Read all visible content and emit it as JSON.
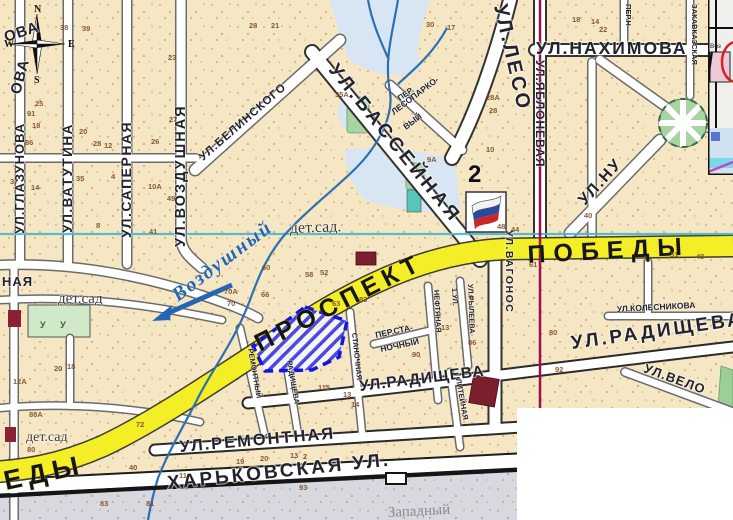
{
  "page": {
    "title": "Городская карта — Проспект Победы"
  },
  "colors": {
    "map_bg": "#f6e7c4",
    "road_yellow": "#f3ee25",
    "river_blue": "#2e6fb4",
    "grid_cyan": "#45b8cc",
    "route_red": "#99114d",
    "selection_blue": "#1515e0",
    "park_green": "#a8d4a4",
    "flag_blue": "#2b4a9e",
    "flag_red": "#cc2525",
    "label_dark": "#23232e",
    "number_brown": "#7c4a26"
  },
  "compass": {
    "n": "N",
    "w": "W",
    "e": "E",
    "s": "S"
  },
  "zone_number": "2",
  "inset": {
    "label": "Воз"
  },
  "labels": {
    "streets": [
      {
        "id": "glazunova",
        "t": "УЛ.ГЛАЗУНОВА",
        "x": 24,
        "y": 234,
        "r": -90,
        "s": 13,
        "ls": 1
      },
      {
        "id": "vatutina",
        "t": "УЛ.ВАТУТИНА",
        "x": 72,
        "y": 233,
        "r": -90,
        "s": 13.5,
        "ls": 1.5
      },
      {
        "id": "sapernaya",
        "t": "УЛ.САПЕРНАЯ",
        "x": 131,
        "y": 238,
        "r": -90,
        "s": 14,
        "ls": 1.5
      },
      {
        "id": "vozdushnaya-street",
        "t": "УЛ.ВОЗДУШНАЯ",
        "x": 185,
        "y": 247,
        "r": -90,
        "s": 14.5,
        "ls": 2
      },
      {
        "id": "ova-partial-1",
        "t": "ОВА",
        "x": 6,
        "y": 42,
        "r": -18,
        "s": 15,
        "ls": 1
      },
      {
        "id": "ova-partial-2",
        "t": "ОВА",
        "x": 20,
        "y": 95,
        "r": -75,
        "s": 15,
        "ls": 1
      },
      {
        "id": "naya-partial",
        "t": "НАЯ",
        "x": 2,
        "y": 286,
        "r": 0,
        "s": 13,
        "ls": 1
      },
      {
        "id": "belinskogo",
        "t": "УЛ.БЕЛИНСКОГО",
        "x": 203,
        "y": 161,
        "r": -41,
        "s": 11.5,
        "ls": 1
      },
      {
        "id": "basseynaya",
        "t": "УЛ.БАССЕЙНАЯ",
        "x": 328,
        "y": 70,
        "r": 51,
        "s": 19,
        "ls": 4
      },
      {
        "id": "lesoparkovy-1",
        "t": "ПЕР.",
        "x": 400,
        "y": 101,
        "r": -35,
        "s": 8,
        "ls": 0
      },
      {
        "id": "lesoparkovy-2",
        "t": "ЛЕСОПАРКО-",
        "x": 394,
        "y": 115,
        "r": -37,
        "s": 8.5,
        "ls": 0
      },
      {
        "id": "lesoparkovy-3",
        "t": "ВЫЙ",
        "x": 406,
        "y": 130,
        "r": -37,
        "s": 8.5,
        "ls": 0
      },
      {
        "id": "leso",
        "t": "УЛ.ЛЕСО",
        "x": 494,
        "y": 6,
        "r": 77,
        "s": 20,
        "ls": 3
      },
      {
        "id": "nakhimova",
        "t": "УЛ.НАХИМОВА",
        "x": 536,
        "y": 54,
        "r": 0,
        "s": 17.5,
        "ls": 2
      },
      {
        "id": "yablonevaya",
        "t": "УЛ.ЯБЛОНЕВАЯ",
        "x": 536,
        "y": 60,
        "r": 90,
        "s": 12,
        "ls": 1
      },
      {
        "id": "per-n",
        "t": "ПЕР.Н",
        "x": 626,
        "y": 4,
        "r": 90,
        "s": 7.5,
        "ls": 0
      },
      {
        "id": "zakavkazskaya",
        "t": "ЗАКАВКАЗСКАЯ",
        "x": 692,
        "y": 4,
        "r": 90,
        "s": 7.5,
        "ls": 0
      },
      {
        "id": "nu",
        "t": "УЛ.НУ",
        "x": 585,
        "y": 206,
        "r": -48,
        "s": 16,
        "ls": 2
      },
      {
        "id": "vagonos",
        "t": "УЛ.ВАГОНОС",
        "x": 506,
        "y": 230,
        "r": 90,
        "s": 10.5,
        "ls": 1.5
      },
      {
        "id": "kolesnikova",
        "t": "УЛ.КОЛЕСНИКОВА",
        "x": 617,
        "y": 312,
        "r": -3,
        "s": 8.5,
        "ls": 0
      },
      {
        "id": "radishcheva-mid",
        "t": "УЛ.РАДИЩЕВА",
        "x": 360,
        "y": 391,
        "r": -7,
        "s": 15.5,
        "ls": 1
      },
      {
        "id": "radishcheva-big",
        "t": "УЛ.РАДИЩЕВА",
        "x": 572,
        "y": 349,
        "r": -8,
        "s": 19,
        "ls": 3
      },
      {
        "id": "velo",
        "t": "УЛ.ВЕЛО",
        "x": 643,
        "y": 372,
        "r": 20,
        "s": 13,
        "ls": 1
      },
      {
        "id": "remontnaya",
        "t": "УЛ.РЕМОНТНАЯ",
        "x": 180,
        "y": 452,
        "r": -5,
        "s": 16.5,
        "ls": 2
      },
      {
        "id": "kharkovskaya",
        "t": "ХАРЬКОВСКАЯ УЛ.",
        "x": 168,
        "y": 489,
        "r": -6,
        "s": 19,
        "ls": 3
      },
      {
        "id": "stanochnaya",
        "t": "СТАНОЧНАЯ",
        "x": 352,
        "y": 333,
        "r": 84,
        "s": 7.5,
        "ls": 0
      },
      {
        "id": "per-stanochny-1",
        "t": "ПЕР.СТА-",
        "x": 376,
        "y": 338,
        "r": -12,
        "s": 8.5,
        "ls": 0
      },
      {
        "id": "per-stanochny-2",
        "t": "НОЧНЫЙ",
        "x": 381,
        "y": 352,
        "r": -12,
        "s": 8.5,
        "ls": 0
      },
      {
        "id": "neftyanaya",
        "t": "НЕФТЯНАЯ",
        "x": 434,
        "y": 290,
        "r": 87,
        "s": 7.5,
        "ls": 0
      },
      {
        "id": "ul-1",
        "t": "1.УЛ.",
        "x": 452,
        "y": 288,
        "r": 87,
        "s": 7.5,
        "ls": 0
      },
      {
        "id": "ryleeva",
        "t": "УЛ.РЫЛЕЕВА",
        "x": 468,
        "y": 284,
        "r": 88,
        "s": 7.5,
        "ls": 0
      },
      {
        "id": "liteynaya",
        "t": "ЛИТЕЙНАЯ",
        "x": 456,
        "y": 379,
        "r": 80,
        "s": 7.5,
        "ls": 0
      },
      {
        "id": "remontny-per",
        "t": "РЕМОНТНЫЙ",
        "x": 248,
        "y": 349,
        "r": 80,
        "s": 7.5,
        "ls": 0
      },
      {
        "id": "radishcheva-small",
        "t": "РАДИЩЕВА",
        "x": 287,
        "y": 361,
        "r": 80,
        "s": 7.5,
        "ls": 0
      },
      {
        "id": "prospekt",
        "t": "ПРОСПЕКТ",
        "x": 260,
        "y": 352,
        "r": -27,
        "s": 25,
        "ls": 6,
        "cls": "yellow-label"
      },
      {
        "id": "pobedy",
        "t": "ПОБЕДЫ",
        "x": 528,
        "y": 263,
        "r": -3,
        "s": 25,
        "ls": 8,
        "cls": "yellow-label"
      },
      {
        "id": "edy",
        "t": "ЕДЫ",
        "x": 6,
        "y": 490,
        "r": -12,
        "s": 27,
        "ls": 6,
        "cls": "yellow-label"
      }
    ],
    "places": [
      {
        "id": "det-sad-1",
        "t": "дет.сад.",
        "x": 290,
        "y": 233,
        "r": -2,
        "s": 16,
        "cls": "serif"
      },
      {
        "id": "det-sad-2",
        "t": "дет.сад",
        "x": 58,
        "y": 303,
        "r": 0,
        "s": 15,
        "cls": "serif"
      },
      {
        "id": "det-sad-3",
        "t": "дет.сад",
        "x": 26,
        "y": 441,
        "r": 0,
        "s": 14,
        "cls": "serif"
      },
      {
        "id": "vozdushny-river",
        "t": "Воздушный",
        "x": 178,
        "y": 302,
        "r": -37,
        "s": 20,
        "ls": 2,
        "cls": "blue-serif-italic"
      },
      {
        "id": "zapadny-district",
        "t": "Западный",
        "x": 388,
        "y": 517,
        "r": -3,
        "s": 15,
        "cls": "grey-serif"
      },
      {
        "id": "det-sad-marks",
        "t": "У  У",
        "x": 40,
        "y": 328,
        "r": 0,
        "s": 9,
        "ls": 6,
        "cls": "green-marks"
      }
    ],
    "numbers": [
      [
        "38",
        60,
        30
      ],
      [
        "39",
        82,
        31
      ],
      [
        "23",
        168,
        60
      ],
      [
        "91",
        27,
        116
      ],
      [
        "25",
        35,
        106
      ],
      [
        "18",
        32,
        128
      ],
      [
        "86",
        25,
        145
      ],
      [
        "20",
        79,
        134
      ],
      [
        "28",
        93,
        146
      ],
      [
        "12",
        104,
        148
      ],
      [
        "35",
        76,
        181
      ],
      [
        "4",
        111,
        179
      ],
      [
        "37",
        10,
        184
      ],
      [
        "14",
        31,
        190
      ],
      [
        "27",
        169,
        122
      ],
      [
        "26",
        151,
        144
      ],
      [
        "10А",
        148,
        189
      ],
      [
        "49",
        167,
        201
      ],
      [
        "41",
        149,
        234
      ],
      [
        "8",
        96,
        228
      ],
      [
        "28",
        249,
        28
      ],
      [
        "21",
        271,
        28
      ],
      [
        "35А",
        335,
        97
      ],
      [
        "30",
        426,
        27
      ],
      [
        "17",
        447,
        30
      ],
      [
        "9А",
        427,
        162
      ],
      [
        "28А",
        486,
        100
      ],
      [
        "28",
        489,
        113
      ],
      [
        "10",
        486,
        152
      ],
      [
        "22",
        599,
        32
      ],
      [
        "18",
        572,
        22
      ],
      [
        "14",
        591,
        24
      ],
      [
        "40",
        584,
        218
      ],
      [
        "44",
        511,
        232
      ],
      [
        "48",
        497,
        229
      ],
      [
        "70А",
        224,
        294
      ],
      [
        "70",
        227,
        306
      ],
      [
        "60",
        262,
        270
      ],
      [
        "66",
        261,
        297
      ],
      [
        "58",
        305,
        277
      ],
      [
        "52",
        320,
        275
      ],
      [
        "61",
        529,
        267
      ],
      [
        "51",
        670,
        257
      ],
      [
        "49",
        696,
        259
      ],
      [
        "63",
        332,
        306
      ],
      [
        "83",
        359,
        302
      ],
      [
        "90",
        412,
        357
      ],
      [
        "13",
        441,
        330
      ],
      [
        "6",
        469,
        300
      ],
      [
        "86",
        468,
        345
      ],
      [
        "80",
        549,
        335
      ],
      [
        "92",
        555,
        372
      ],
      [
        "115",
        318,
        390
      ],
      [
        "13",
        343,
        397
      ],
      [
        "14",
        351,
        407
      ],
      [
        "20",
        54,
        371
      ],
      [
        "18",
        67,
        369
      ],
      [
        "12А",
        13,
        384
      ],
      [
        "80А",
        29,
        417
      ],
      [
        "80",
        27,
        452
      ],
      [
        "72",
        136,
        427
      ],
      [
        "40",
        129,
        470
      ],
      [
        "19",
        236,
        464
      ],
      [
        "20",
        260,
        461
      ],
      [
        "13",
        290,
        458
      ],
      [
        "2",
        303,
        459
      ],
      [
        "93",
        299,
        490
      ],
      [
        "11",
        179,
        478
      ],
      [
        "83",
        100,
        506
      ],
      [
        "81",
        146,
        506
      ]
    ]
  }
}
